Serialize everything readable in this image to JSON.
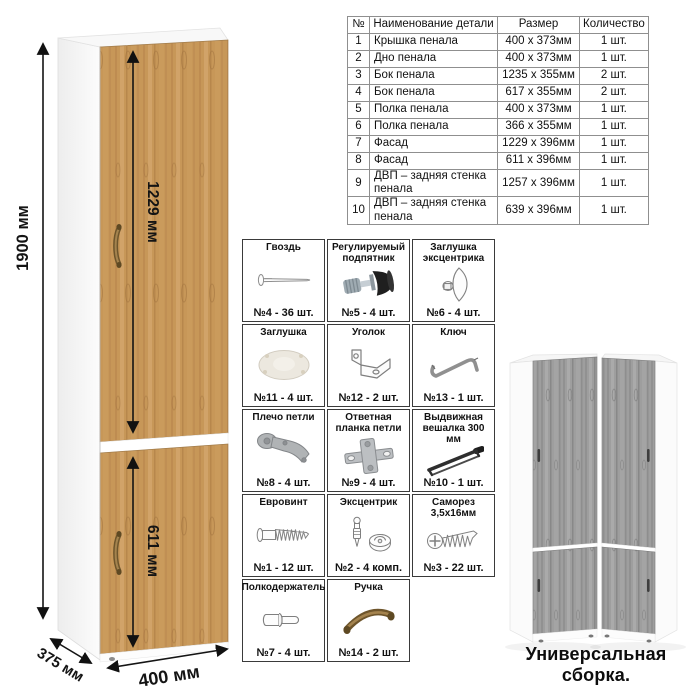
{
  "illustration": {
    "height_label": "1900 мм",
    "upper_door_label": "1229 мм",
    "lower_door_label": "611 мм",
    "depth_label": "375 мм",
    "width_label": "400 мм"
  },
  "parts_table": {
    "headers": [
      "№",
      "Наименование детали",
      "Размер",
      "Количество"
    ],
    "rows": [
      [
        "1",
        "Крышка пенала",
        "400 x 373мм",
        "1 шт."
      ],
      [
        "2",
        "Дно пенала",
        "400 x 373мм",
        "1 шт."
      ],
      [
        "3",
        "Бок пенала",
        "1235 x 355мм",
        "2 шт."
      ],
      [
        "4",
        "Бок пенала",
        "617 x 355мм",
        "2 шт."
      ],
      [
        "5",
        "Полка пенала",
        "400 x 373мм",
        "1 шт."
      ],
      [
        "6",
        "Полка пенала",
        "366 x 355мм",
        "1 шт."
      ],
      [
        "7",
        "Фасад",
        "1229 x 396мм",
        "1 шт."
      ],
      [
        "8",
        "Фасад",
        "611 x 396мм",
        "1 шт."
      ],
      [
        "9",
        "ДВП – задняя стенка пенала",
        "1257 x 396мм",
        "1 шт."
      ],
      [
        "10",
        "ДВП – задняя стенка пенала",
        "639 x 396мм",
        "1 шт."
      ]
    ]
  },
  "hardware": {
    "items": [
      {
        "name": "Гвоздь",
        "icon": "nail-icon",
        "count": "№4 - 36 шт."
      },
      {
        "name": "Регулируемый подпятник",
        "icon": "adjustable-foot-icon",
        "count": "№5 - 4 шт."
      },
      {
        "name": "Заглушка эксцентрика",
        "icon": "cam-cap-icon",
        "count": "№6 - 4 шт."
      },
      {
        "name": "Заглушка",
        "icon": "plug-icon",
        "count": "№11 - 4 шт."
      },
      {
        "name": "Уголок",
        "icon": "corner-bracket-icon",
        "count": "№12 - 2 шт."
      },
      {
        "name": "Ключ",
        "icon": "hex-key-icon",
        "count": "№13 - 1 шт."
      },
      {
        "name": "Плечо петли",
        "icon": "hinge-arm-icon",
        "count": "№8 - 4 шт."
      },
      {
        "name": "Ответная планка петли",
        "icon": "hinge-plate-icon",
        "count": "№9 - 4 шт."
      },
      {
        "name": "Выдвижная вешалка 300 мм",
        "icon": "pullout-hanger-icon",
        "count": "№10 - 1 шт."
      },
      {
        "name": "Евровинт",
        "icon": "confirmat-screw-icon",
        "count": "№1 - 12 шт."
      },
      {
        "name": "Эксцентрик",
        "icon": "cam-lock-icon",
        "count": "№2 - 4 комп."
      },
      {
        "name": "Саморез 3,5х16мм",
        "icon": "screw-icon",
        "count": "№3 - 22 шт."
      },
      {
        "name": "Полкодержатель",
        "icon": "shelf-pin-icon",
        "count": "№7 - 4 шт."
      },
      {
        "name": "Ручка",
        "icon": "handle-icon",
        "count": "№14 - 2 шт."
      }
    ]
  },
  "footer": {
    "caption": "Универсальная сборка."
  },
  "colors": {
    "wood": "#c79758",
    "gray_wood": "#9e9e9e",
    "dimension_lines": "#141414",
    "table_border": "#8f8f8f",
    "hardware_border": "#3a3a3a",
    "handle_brass": "#6e552b"
  }
}
